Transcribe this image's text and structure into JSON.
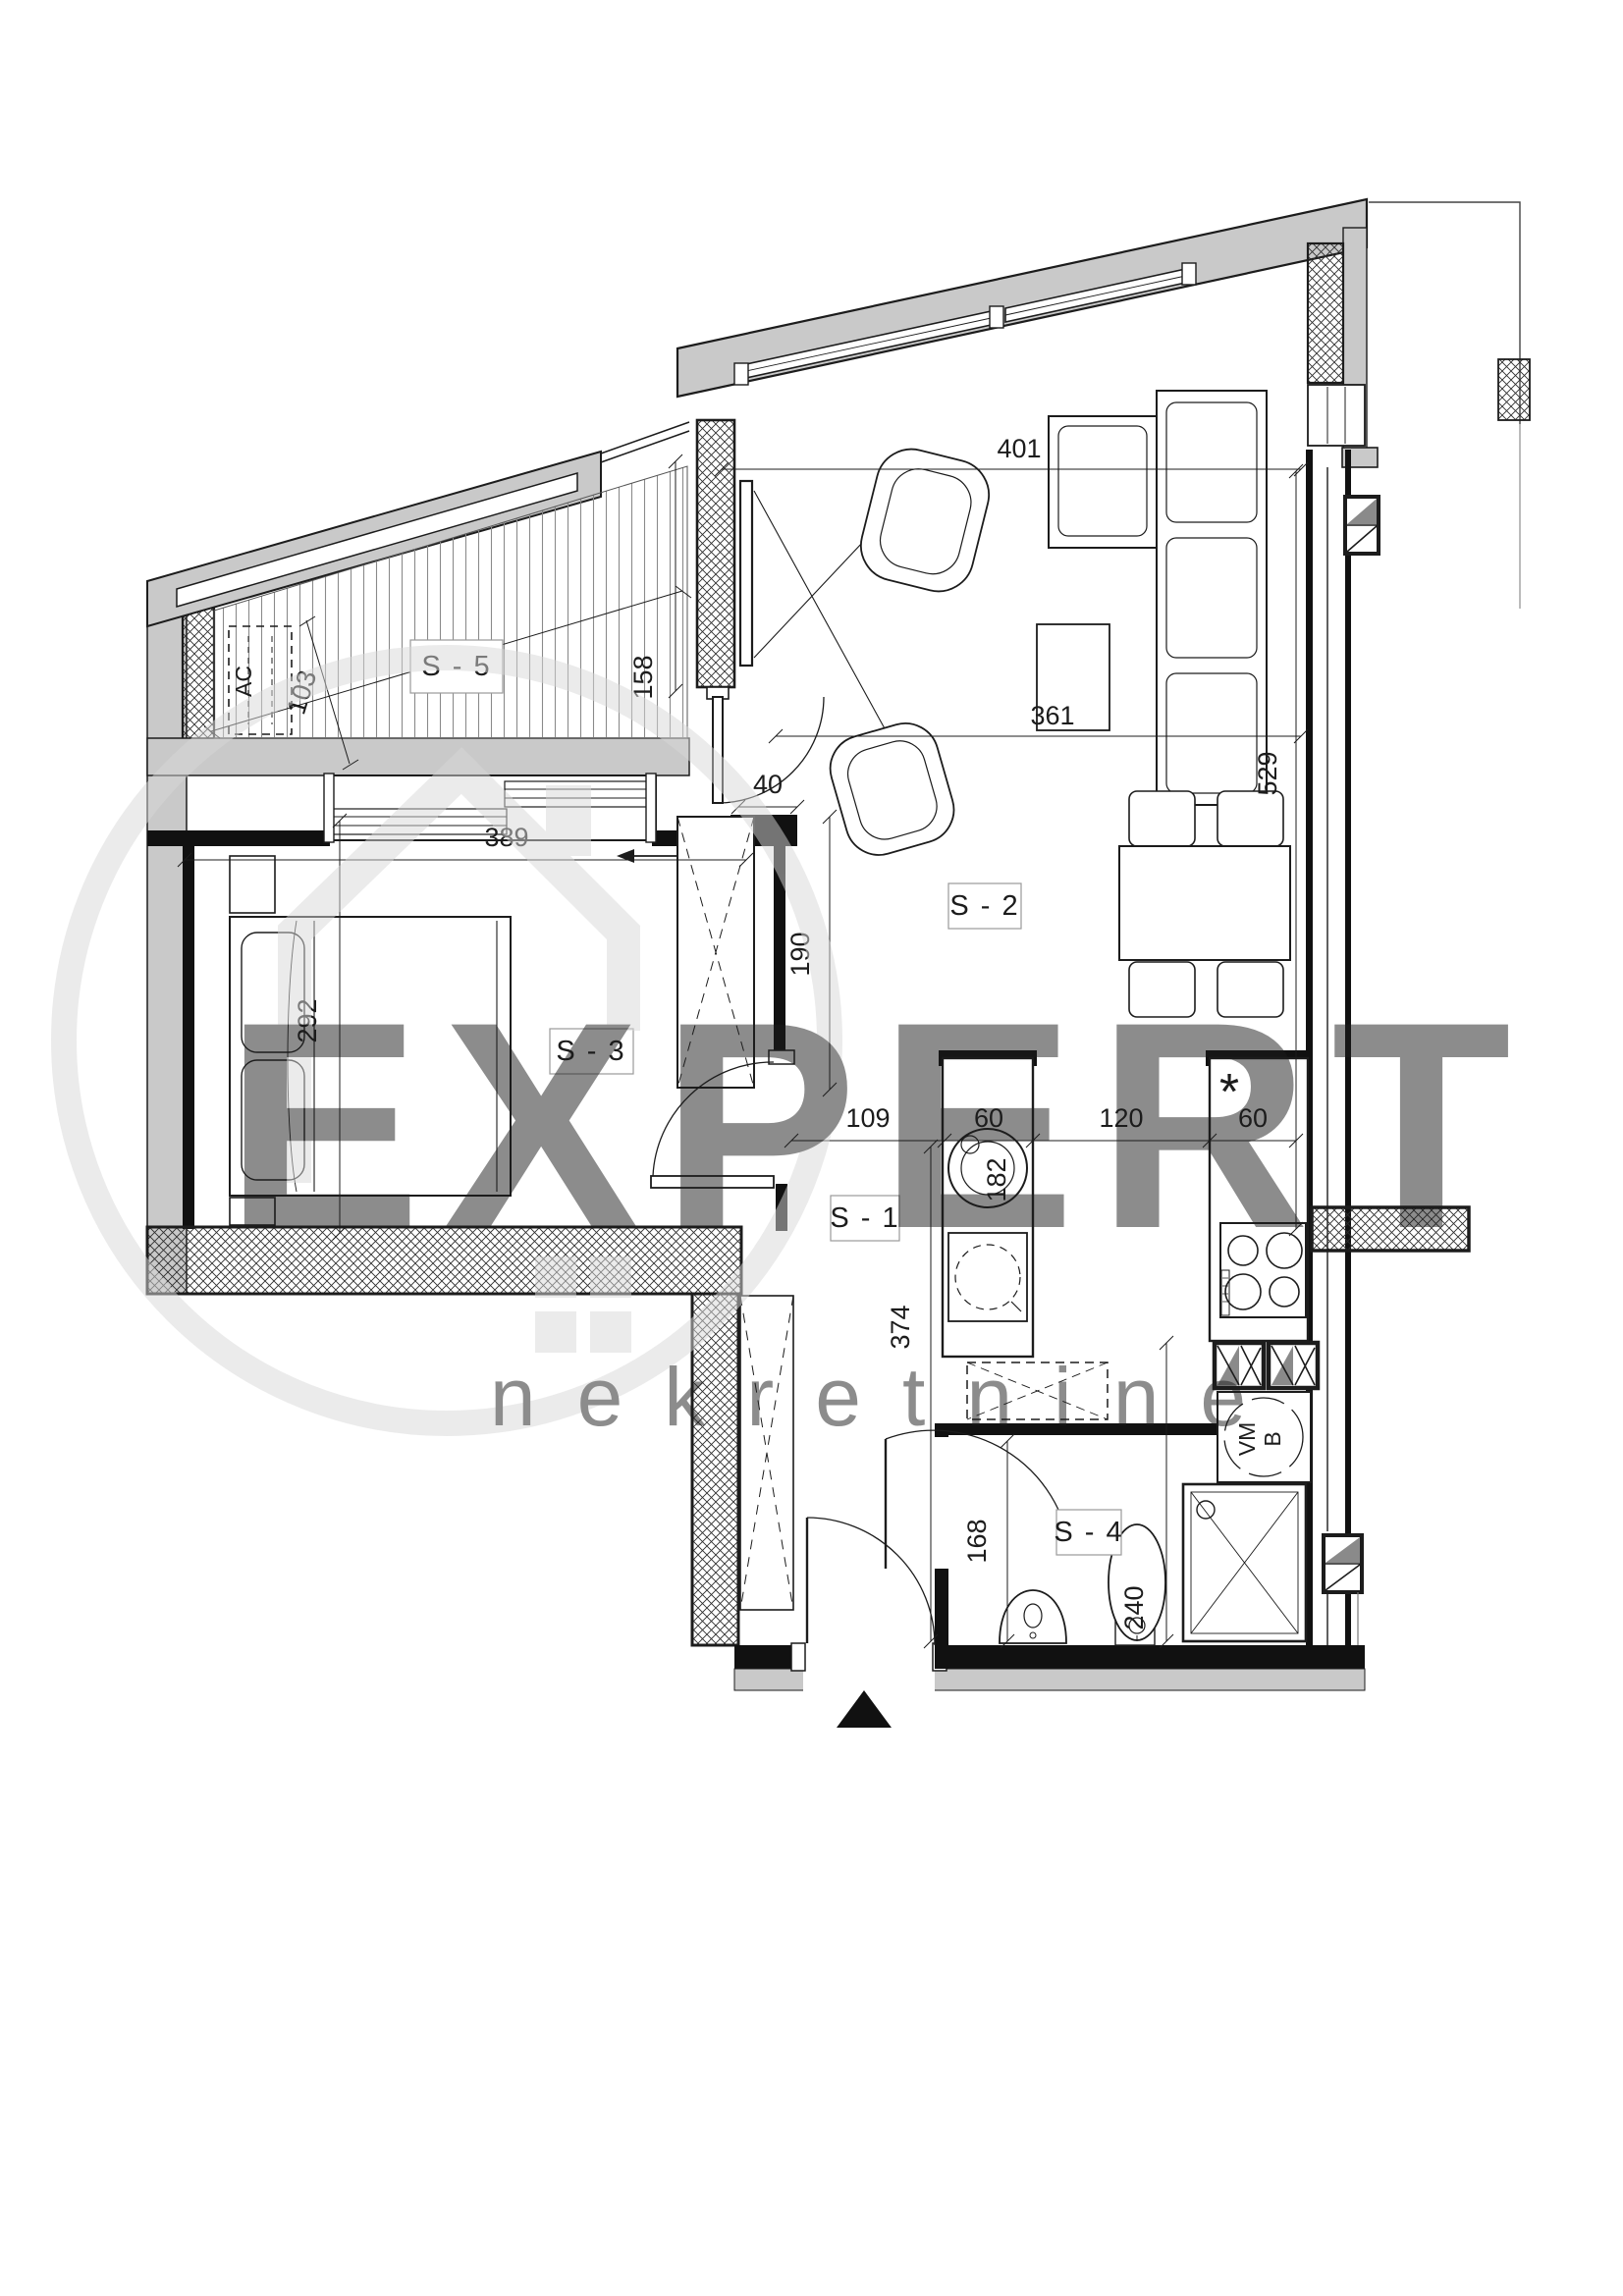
{
  "document": {
    "type": "apartment-floor-plan"
  },
  "watermark": {
    "brand": "EXPERT",
    "tagline": "nekretnine"
  },
  "rooms": [
    {
      "id": "S-1",
      "label": "S - 1"
    },
    {
      "id": "S-2",
      "label": "S - 2"
    },
    {
      "id": "S-3",
      "label": "S - 3"
    },
    {
      "id": "S-4",
      "label": "S - 4"
    },
    {
      "id": "S-5",
      "label": "S - 5"
    }
  ],
  "fixtures": {
    "air_conditioner": "AC",
    "washing_machine": "VM",
    "boiler": "B",
    "hob_marker": "*"
  },
  "dimensions_cm": {
    "living_top": "401",
    "living_right": "529",
    "living_bottom": "361",
    "terrace_width": "319",
    "terrace_left": "103",
    "terrace_right": "158",
    "terrace_door": "40",
    "bedroom_width": "389",
    "bedroom_depth": "292",
    "wardrobe_length": "190",
    "hall_width": "109",
    "counter_left": "60",
    "kitchen_passage": "120",
    "counter_right": "60",
    "counter_length": "182",
    "hall_length": "374",
    "bathroom_width": "168",
    "bathroom_length": "240"
  },
  "colors": {
    "wall": "#c9c9c9",
    "line": "#1c1c1c",
    "shaft": "#8a8a8a",
    "watermark": "#d8d8d8"
  }
}
